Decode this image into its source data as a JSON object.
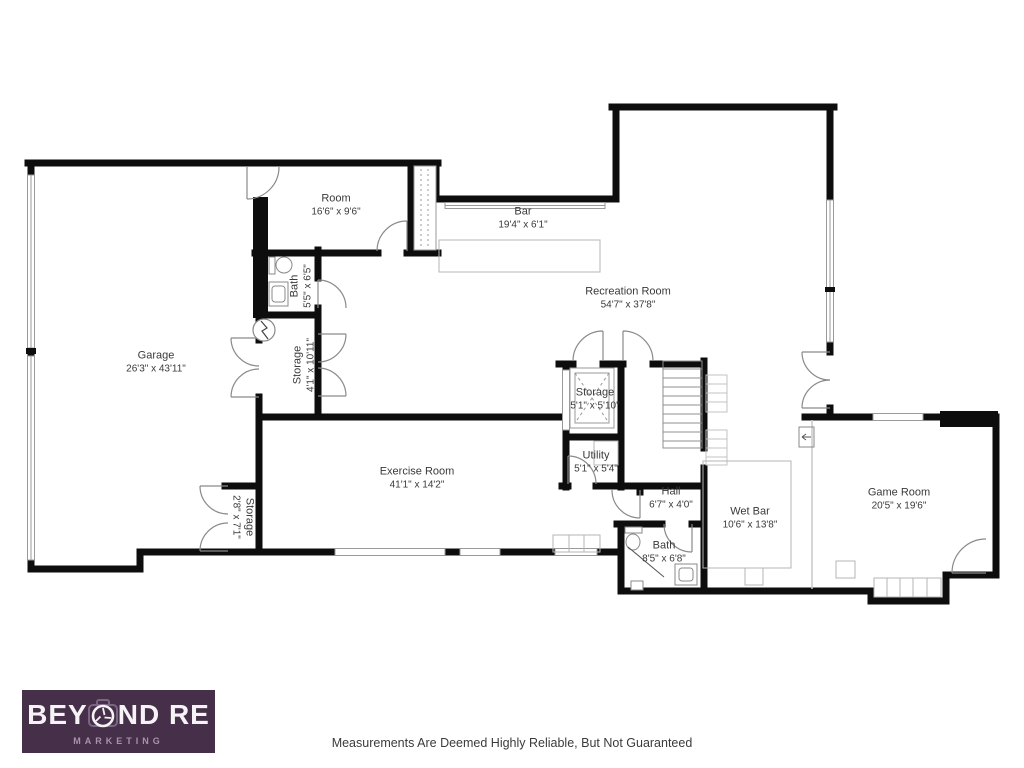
{
  "page": {
    "background": "#ffffff",
    "disclaimer": "Measurements Are Deemed Highly Reliable, But Not Guaranteed"
  },
  "logo": {
    "brand_pre": "BEY",
    "brand_post": "ND RE",
    "tagline": "MARKETING",
    "bg_color": "#463049",
    "text_color": "#f6f3f6",
    "tagline_color": "#a693ab"
  },
  "floorplan": {
    "wall_color": "#0d0d0d",
    "rooms": [
      {
        "name": "Room",
        "dims": "16'6\" x 9'6\""
      },
      {
        "name": "Bar",
        "dims": "19'4\" x 6'1\""
      },
      {
        "name": "Bath",
        "dims": "5'5\" x 6'5\""
      },
      {
        "name": "Garage",
        "dims": "26'3\" x 43'11\""
      },
      {
        "name": "Storage",
        "dims": "4'1\" x 10'11\""
      },
      {
        "name": "Recreation Room",
        "dims": "54'7\" x 37'8\""
      },
      {
        "name": "Storage",
        "dims": "5'1\" x 5'10\""
      },
      {
        "name": "Utility",
        "dims": "5'1\" x 5'4\""
      },
      {
        "name": "Exercise Room",
        "dims": "41'1\" x 14'2\""
      },
      {
        "name": "Storage",
        "dims": "2'8\" x 7'1\""
      },
      {
        "name": "Hall",
        "dims": "6'7\" x 4'0\""
      },
      {
        "name": "Wet Bar",
        "dims": "10'6\" x 13'8\""
      },
      {
        "name": "Bath",
        "dims": "8'5\" x 6'8\""
      },
      {
        "name": "Game Room",
        "dims": "20'5\" x 19'6\""
      }
    ]
  }
}
